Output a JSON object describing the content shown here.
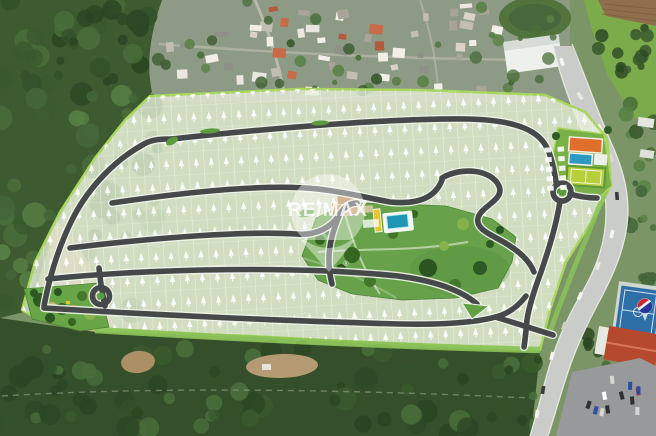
{
  "watermark": {
    "brand_text": "RE/MAX",
    "registered_mark": "®",
    "shape": "balloon-pin",
    "fill_opacity": "0.42"
  },
  "map_marker": {
    "name": "remax-balloon-marker",
    "top_color": "#c92b2b",
    "band_color": "#f5f5f5",
    "bottom_color": "#27379b"
  },
  "site_plan": {
    "features": {
      "lots": {
        "label": "residential-lots",
        "color": "#e8f1db"
      },
      "roads": {
        "label": "internal-roads",
        "color": "#45494a"
      },
      "border": {
        "label": "plan-border",
        "color": "#a8d55c"
      },
      "park": {
        "label": "central-park",
        "color": "#67a24a"
      },
      "pool": {
        "label": "swimming-pool",
        "color": "#1f96b4"
      },
      "clubhouse": {
        "label": "clubhouse",
        "color": "#c09058"
      },
      "court_orange": {
        "label": "sports-court-orange",
        "color": "#e06f2c"
      },
      "court_blue": {
        "label": "sports-court-blue",
        "color": "#2e9ac4"
      },
      "court_green": {
        "label": "sports-court-green",
        "color": "#b8cf3c"
      },
      "pocket_park": {
        "label": "pocket-park",
        "color": "#68a546"
      }
    }
  },
  "photo": {
    "forest": {
      "label": "forest-canopy",
      "color": "#3e5a30"
    },
    "village": {
      "label": "village-rooftops",
      "color": "#8d9b86"
    },
    "highway": {
      "label": "highway",
      "color": "#c9ccc8"
    },
    "pasture": {
      "label": "pasture-field",
      "color": "#7cab4c"
    }
  }
}
